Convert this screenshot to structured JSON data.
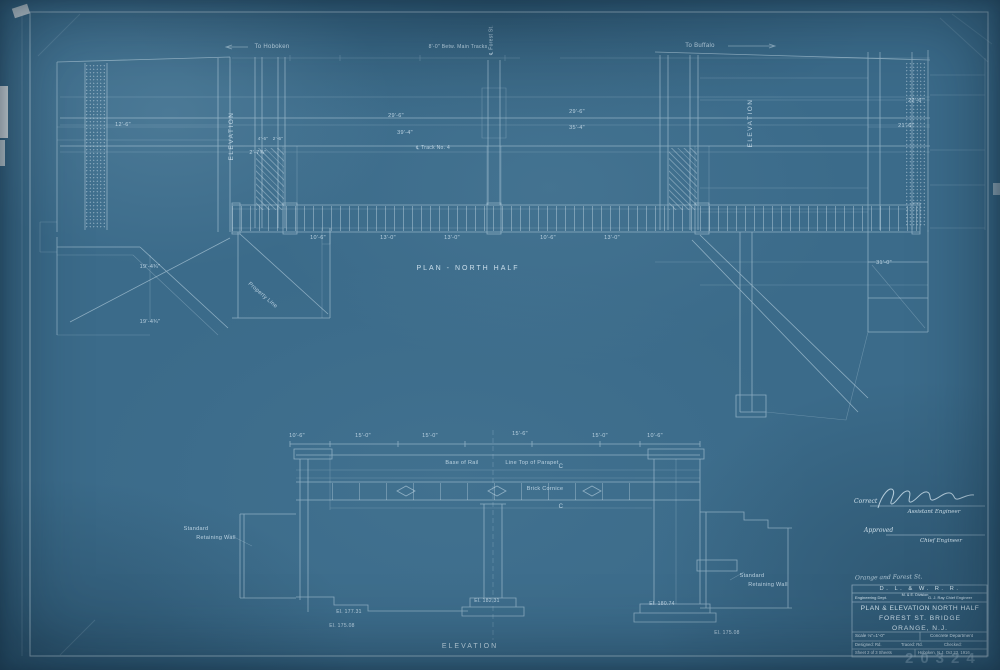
{
  "title_block": {
    "note": "Orange and Forest St.",
    "railroad": "D. L. & W. R. R.",
    "dept": "Engineering Dept.",
    "division": "M. & E. Division",
    "chief": "G. J. Ray Chief Engineer",
    "line1": "PLAN & ELEVATION NORTH HALF",
    "line2": "FOREST ST. BRIDGE",
    "line3": "ORANGE, N.J.",
    "scale": "Scale ⅛\"=1'-0\"",
    "department": "Concrete Department",
    "designed": "Designed: Rd.",
    "traced": "Traced: Rd.",
    "checked": "Checked:",
    "sheet": "Sheet 2 of 3 Sheets",
    "place_date": "Hoboken, N.J. Oct 23, 1916",
    "stamp": "20324"
  },
  "signature_block": {
    "correct": "Correct",
    "assistant": "Assistant Engineer",
    "approved": "Approved",
    "chief": "Chief Engineer"
  },
  "annotations": [
    {
      "id": "to-hoboken",
      "text": "To Hoboken"
    },
    {
      "id": "to-buffalo",
      "text": "To Buffalo"
    },
    {
      "id": "betw-main-tracks",
      "text": "8'-0\" Betw. Main Tracks"
    },
    {
      "id": "cl-forest-st",
      "text": "℄ Forest St."
    },
    {
      "id": "elevation-left",
      "text": "ELEVATION"
    },
    {
      "id": "elevation-right",
      "text": "ELEVATION"
    },
    {
      "id": "plan-title",
      "text": "PLAN - NORTH HALF"
    },
    {
      "id": "elevation-bottom",
      "text": "ELEVATION"
    },
    {
      "id": "base-of-rail",
      "text": "Base of Rail"
    },
    {
      "id": "line-top-parapet",
      "text": "Line Top of Parapet"
    },
    {
      "id": "brick-cornice",
      "text": "Brick Cornice"
    },
    {
      "id": "std-wall-left-1",
      "text": "Standard"
    },
    {
      "id": "std-wall-left-2",
      "text": "Retaining Wall"
    },
    {
      "id": "std-wall-right-1",
      "text": "Standard"
    },
    {
      "id": "std-wall-right-2",
      "text": "Retaining Wall"
    },
    {
      "id": "property-line",
      "text": "Property Line"
    },
    {
      "id": "dim-29-6-a",
      "text": "29'-6\""
    },
    {
      "id": "dim-39-4",
      "text": "39'-4\""
    },
    {
      "id": "dim-29-6-b",
      "text": "29'-6\""
    },
    {
      "id": "dim-35-4",
      "text": "35'-4\""
    },
    {
      "id": "dim-22-6",
      "text": "22'-6\""
    },
    {
      "id": "dim-21-6",
      "text": "21'-6\""
    },
    {
      "id": "dim-12-6",
      "text": "12'-6\""
    },
    {
      "id": "dim-19-4-a",
      "text": "19'-4¾\""
    },
    {
      "id": "dim-19-4-b",
      "text": "19'-4¾\""
    },
    {
      "id": "dim-2-7",
      "text": "2'-7¾\""
    },
    {
      "id": "dim-10-6-a",
      "text": "10'-6\""
    },
    {
      "id": "dim-13-0-a",
      "text": "13'-0\""
    },
    {
      "id": "dim-13-0-b",
      "text": "13'-0\""
    },
    {
      "id": "dim-10-6-b",
      "text": "10'-6\""
    },
    {
      "id": "dim-13-0-c",
      "text": "13'-0\""
    },
    {
      "id": "dim-10-6-c",
      "text": "10'-6\""
    },
    {
      "id": "dim-15-0-a",
      "text": "15'-0\""
    },
    {
      "id": "dim-15-0-b",
      "text": "15'-0\""
    },
    {
      "id": "dim-15-6",
      "text": "15'-6\""
    },
    {
      "id": "dim-15-0-c",
      "text": "15'-0\""
    },
    {
      "id": "dim-10-6-d",
      "text": "10'-6\""
    },
    {
      "id": "el-177-31",
      "text": "El. 177.31"
    },
    {
      "id": "el-175-08-a",
      "text": "El. 175.08"
    },
    {
      "id": "el-182-31",
      "text": "El. 182.31"
    },
    {
      "id": "el-180-74",
      "text": "El. 180.74"
    },
    {
      "id": "el-175-08-b",
      "text": "El. 175.08"
    },
    {
      "id": "section-c-top",
      "text": "C"
    },
    {
      "id": "section-c-bottom",
      "text": "C"
    },
    {
      "id": "cl-track-4",
      "text": "℄ Track No. 4"
    },
    {
      "id": "dim-31-0",
      "text": "31'-0\""
    },
    {
      "id": "dim-4-6",
      "text": "4'-6\""
    },
    {
      "id": "dim-2-6",
      "text": "2'-6\""
    }
  ]
}
